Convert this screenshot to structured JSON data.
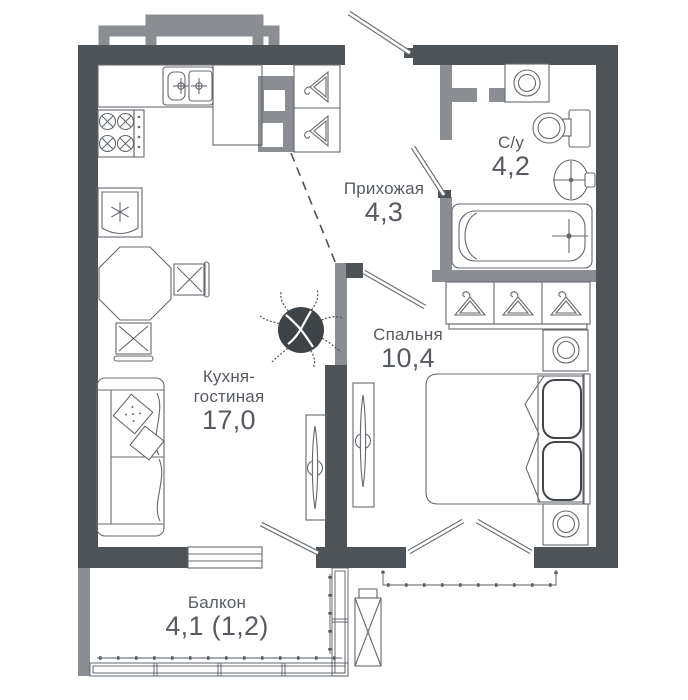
{
  "rooms": {
    "kitchen_living": {
      "name": "Кухня-\nгостиная",
      "area": "17,0"
    },
    "hallway": {
      "name": "Прихожая",
      "area": "4,3"
    },
    "bathroom": {
      "name": "С/у",
      "area": "4,2"
    },
    "bedroom": {
      "name": "Спальня",
      "area": "10,4"
    },
    "balcony": {
      "name": "Балкон",
      "area": "4,1 (1,2)"
    }
  },
  "colors": {
    "wall_dark": "#4e5358",
    "wall_light": "#8a8e92",
    "furniture_line": "#64696e",
    "text": "#565b61",
    "background": "#ffffff"
  },
  "icons": {
    "kitchen-sink-icon": "double kitchen sink with taps",
    "stove-icon": "4-burner cooktop",
    "fridge-icon": "refrigerator with snowflake",
    "dining-table-icon": "octagonal table",
    "chair-icon": "chair with cross seat",
    "sofa-icon": "sofa with pillows",
    "plant-icon": "potted plant",
    "tv-panel-icon": "wall TV console",
    "bed-icon": "double bed with pillows",
    "nightstand-icon": "nightstand with lamp",
    "wardrobe-icon": "wardrobe section with hanger",
    "hanger-icon": "clothes hanger",
    "washing-machine-icon": "washing machine",
    "toilet-icon": "toilet",
    "bath-sink-icon": "wash basin",
    "bathtub-icon": "bathtub",
    "ac-unit-icon": "air conditioner outdoor unit",
    "door-swing-icon": "door leaf",
    "balcony-glazing-icon": "glazed balcony band"
  }
}
